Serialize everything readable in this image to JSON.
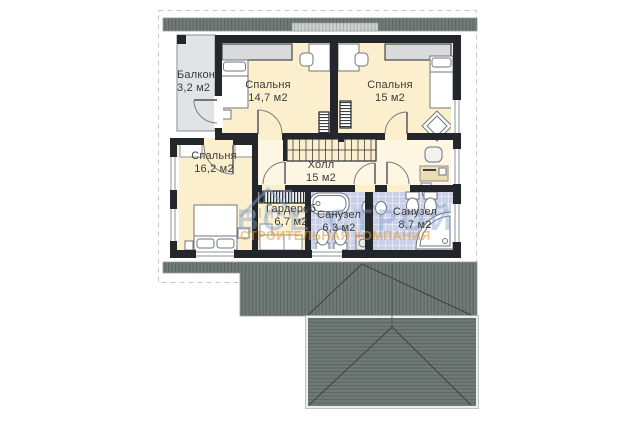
{
  "rooms": {
    "balcony": {
      "name": "Балкон",
      "area": "3,2 м2"
    },
    "bedroom_top_left": {
      "name": "Спальня",
      "area": "14,7 м2"
    },
    "bedroom_top_right": {
      "name": "Спальня",
      "area": "15 м2"
    },
    "bedroom_left": {
      "name": "Спальня",
      "area": "16,2 м2"
    },
    "hall": {
      "name": "Холл",
      "area": "15 м2"
    },
    "wardrobe": {
      "name": "Гардероб",
      "area": "6,7 м2"
    },
    "bathroom_small": {
      "name": "Санузел",
      "area": "6,3 м2"
    },
    "bathroom_large": {
      "name": "Санузел",
      "area": "8,7 м2"
    }
  },
  "watermark": {
    "brand": "ВСЕ СТРОЙ",
    "tagline": "СТРОИТЕЛЬНАЯ КОМПАНИЯ"
  },
  "colors": {
    "wall": "#23272b",
    "room_fill": "#fcefcd",
    "hall_fill": "#fdf6e2",
    "bath_tile": "#cad0e8",
    "balcony_fill": "#e1e3e5",
    "wardrobe_fill": "#d8dadc",
    "roof": "#707a76",
    "watermark_blue": "#7e9ece",
    "watermark_orange": "#e0993c"
  }
}
